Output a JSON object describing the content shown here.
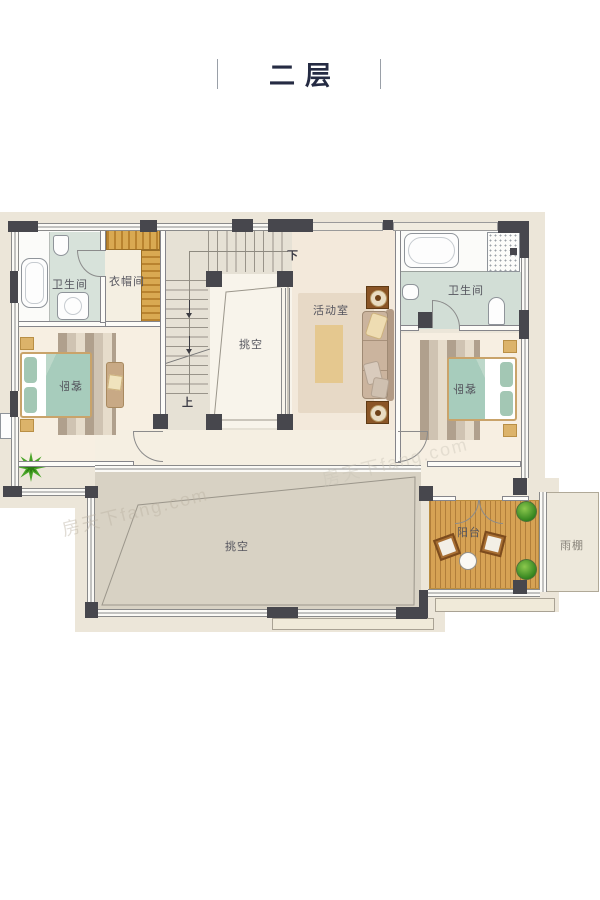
{
  "title": {
    "text": "二层"
  },
  "labels": {
    "bath_left": "卫生间",
    "cloakroom": "衣帽间",
    "void_stairwell": "挑空",
    "activity_room": "活动室",
    "bath_right": "卫生间",
    "bedroom_left": "客卧",
    "bedroom_right": "客卧",
    "void_large": "挑空",
    "balcony": "阳台",
    "canopy": "雨棚",
    "stairs_down": "下",
    "stairs_up": "上"
  },
  "watermark": {
    "text": "房天下fang.com"
  },
  "colors": {
    "wall_dark": "#47474d",
    "floor_cream": "#f6eee1",
    "floor_stair": "#e6e1d5",
    "floor_activity": "#f3e9db",
    "bath_teal": "#d7e2da",
    "void_fill": "#d8d2c4",
    "deck_wood": "#d6a254",
    "wardrobe_wood": "#d6a14e",
    "bedding_teal": "#a5cabb",
    "title_navy": "#252b43"
  }
}
